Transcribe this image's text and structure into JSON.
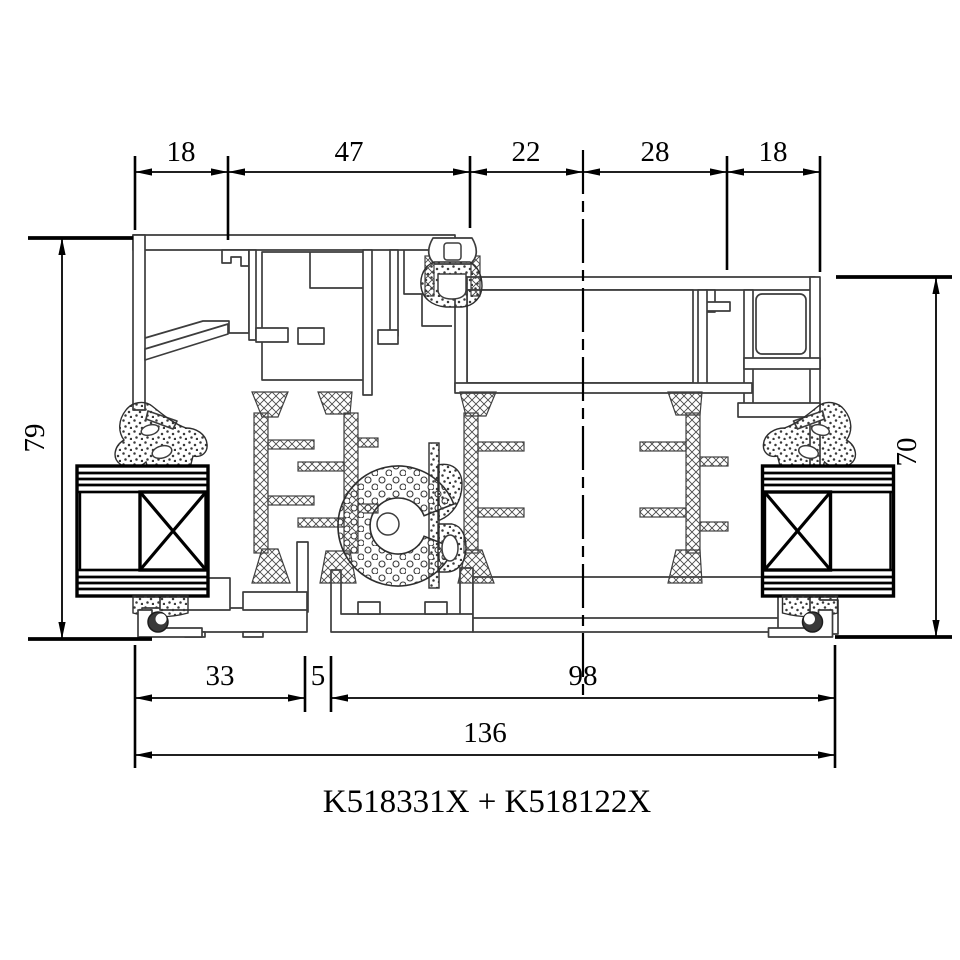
{
  "drawing": {
    "title": "K518331X + K518122X",
    "dims_top": [
      "18",
      "47",
      "22",
      "28",
      "18"
    ],
    "dims_bottom": [
      "33",
      "5",
      "98"
    ],
    "dim_total": "136",
    "dim_left": "79",
    "dim_right": "70",
    "colors": {
      "background": "#ffffff",
      "dimension_line": "#000000",
      "profile_line": "#3d3d3d"
    }
  }
}
